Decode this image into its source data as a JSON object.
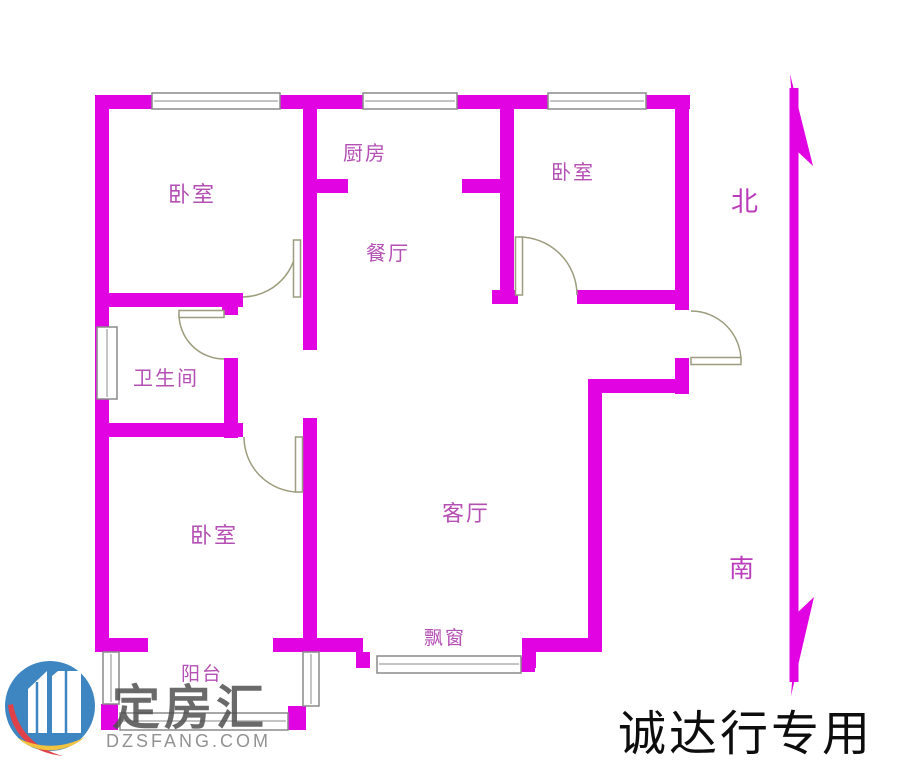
{
  "floor_plan": {
    "rooms": [
      {
        "key": "bedroom-top-left",
        "label": "卧室"
      },
      {
        "key": "kitchen",
        "label": "厨房"
      },
      {
        "key": "bedroom-top-right",
        "label": "卧室"
      },
      {
        "key": "dining-room",
        "label": "餐厅"
      },
      {
        "key": "bathroom",
        "label": "卫生间"
      },
      {
        "key": "bedroom-bottom-left",
        "label": "卧室"
      },
      {
        "key": "living-room",
        "label": "客厅"
      },
      {
        "key": "bay-window",
        "label": "飘窗"
      },
      {
        "key": "balcony",
        "label": "阳台"
      }
    ],
    "compass": {
      "north_label": "北",
      "south_label": "南"
    },
    "colors": {
      "wall": "#e203e2",
      "room_label": "#b44fb4",
      "door_window_line": "#9c9c7e",
      "window_frame": "#8a8a8a"
    }
  },
  "watermark": {
    "brand_name": "定房汇",
    "website": "DZSFANG.COM"
  },
  "branding_text": {
    "agency_label": "诚达行专用"
  }
}
